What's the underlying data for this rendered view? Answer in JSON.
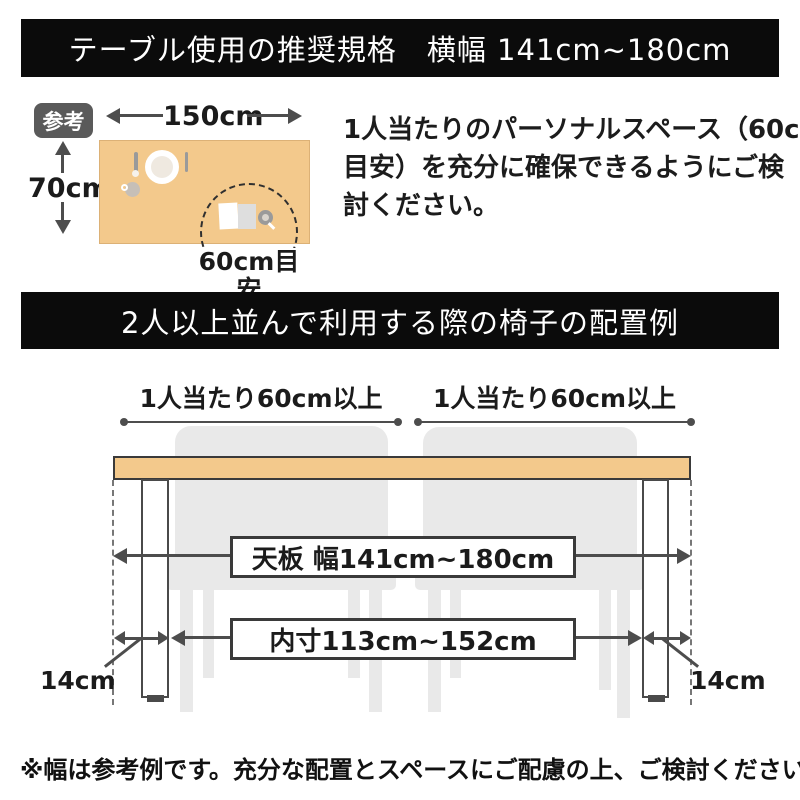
{
  "section1": {
    "banner": "テーブル使用の推奨規格　横幅 141cm~180cm",
    "badge": "参考",
    "width_label": "150cm",
    "depth_label": "70cm",
    "circle_label": "60cm目安",
    "paragraph_lines": [
      "1人当たりのパーソナルスペース（60cm",
      "目安）を充分に確保できるようにご検",
      "討ください。"
    ]
  },
  "section2": {
    "banner": "2人以上並んで利用する際の椅子の配置例",
    "per_person_left": "1人当たり60cm以上",
    "per_person_right": "1人当たり60cm以上",
    "tabletop_label": "天板 幅141cm~180cm",
    "inner_label": "内寸113cm~152cm",
    "leg_offset_left": "14cm",
    "leg_offset_right": "14cm"
  },
  "footer": {
    "note": "※幅は参考例です。充分な配置とスペースにご配慮の上、ご検討ください。"
  },
  "icons": [
    "plate-icon",
    "spoon-icon",
    "knife-icon",
    "cup-icon",
    "book-icon",
    "magnifier-icon"
  ],
  "colors": {
    "banner_bg": "#0b0b0b",
    "tabletop": "#f3c98c",
    "chair": "#e9e9e9",
    "arrow": "#4d4d4d",
    "badge_bg": "#5a5a5a"
  }
}
